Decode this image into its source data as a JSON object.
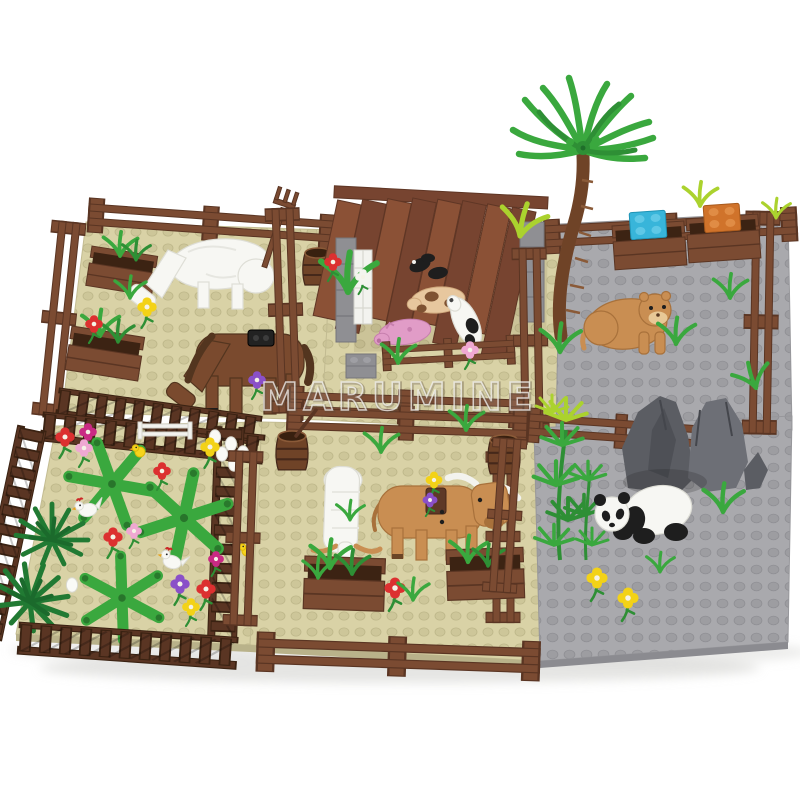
{
  "image": {
    "type": "product-photo",
    "subject": "building-block farm and zoo set with six fenced animal enclosures",
    "background": "#ffffff"
  },
  "watermark": {
    "text": "MARUMINE"
  },
  "palette": {
    "bg": "#ffffff",
    "plate_tan": "#d9d2a6",
    "stud_tan": "#cdc699",
    "stud_tan_e": "#bdb689",
    "plate_gray": "#a9a9ad",
    "stud_gray": "#9d9da1",
    "stud_gray_e": "#8f8f94",
    "plate_tan_edge": "#b9b28a",
    "plate_gray_edge": "#8b8b90",
    "fence_brown": "#7b4b32",
    "fence_dark": "#5a3523",
    "roof_a": "#8b5136",
    "roof_b": "#774430",
    "roof_edge": "#5f3625",
    "wall_gray": "#8f8f93",
    "wall_gray_d": "#76767b",
    "leaf": "#3aa83e",
    "leaf_dark": "#2e8f35",
    "bush": "#217a33",
    "lime": "#abd22e",
    "animal_white": "#f7f7f3",
    "shade_white": "#deded6",
    "black": "#1e1e1e",
    "pig_pink": "#e19cc7",
    "pig_tan": "#e7c79e",
    "nougat": "#c98e52",
    "nougat_d": "#a8713b",
    "horse": "#7a4a2e",
    "horse_d": "#53351f",
    "rock": "#5b5d63",
    "rock_l": "#6d6f76",
    "rock_d": "#44464c",
    "barrel": "#6f4327",
    "brick_blue": "#38b5da",
    "brick_orange": "#d0732b",
    "fl_red": "#dc3030",
    "fl_yellow": "#f3d217",
    "fl_purple": "#8a50c8",
    "fl_pink": "#efa8d2",
    "fl_magenta": "#c92a84",
    "comb_red": "#cc2626",
    "beak_orange": "#e8a21d",
    "shadow": "#cfcfcc"
  },
  "scene": {
    "enclosures": [
      {
        "id": "horse-pen",
        "ground": "tan",
        "animals": [
          "white-cow",
          "brown-horse"
        ],
        "props": [
          "planter-troughs",
          "barrel",
          "pitchfork",
          "flowers"
        ]
      },
      {
        "id": "pig-barn",
        "ground": "tan",
        "animals": [
          "pink-pig",
          "spotted-pig",
          "black-piglets",
          "white-calf"
        ],
        "props": [
          "plank-roof",
          "stone-walls",
          "white-feeder",
          "front-fence"
        ]
      },
      {
        "id": "lion-yard",
        "ground": "gray",
        "animals": [
          "lion"
        ],
        "props": [
          "palm-tree",
          "feed-boxes",
          "blue-brick",
          "orange-brick",
          "grass-tufts"
        ]
      },
      {
        "id": "chicken-garden",
        "ground": "tan",
        "animals": [
          "hens",
          "chicks",
          "eggs"
        ],
        "props": [
          "leaf-plants",
          "bushes",
          "flowers",
          "white-gate",
          "picket-fence"
        ]
      },
      {
        "id": "buffalo-pen",
        "ground": "tan",
        "animals": [
          "white-goat",
          "buffalo"
        ],
        "props": [
          "barrels",
          "planter-troughs",
          "flowers",
          "grass-tufts"
        ]
      },
      {
        "id": "panda-yard",
        "ground": "gray",
        "animals": [
          "panda"
        ],
        "props": [
          "rock-formation",
          "bamboo",
          "flowers",
          "grass-tufts"
        ]
      }
    ]
  }
}
